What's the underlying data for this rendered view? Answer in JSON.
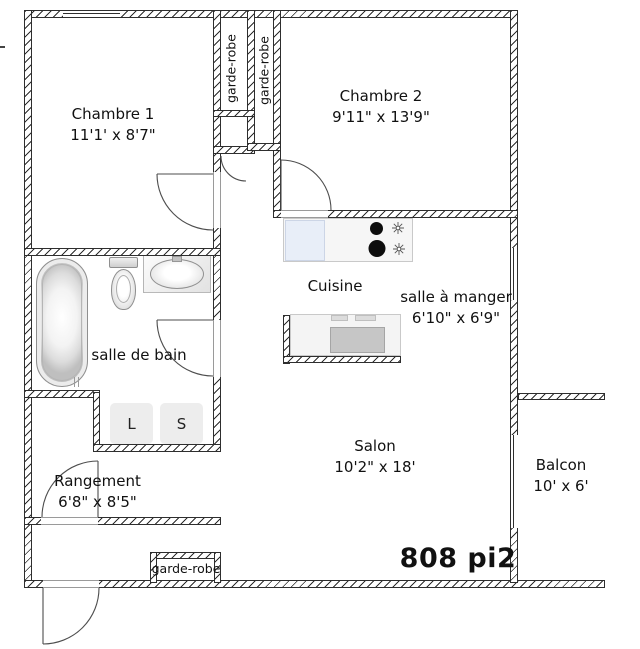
{
  "rooms": {
    "chambre1": {
      "label": "Chambre 1",
      "dims": "11'1' x 8'7\""
    },
    "chambre2": {
      "label": "Chambre 2",
      "dims": "9'11\" x 13'9\""
    },
    "cuisine": {
      "label": "Cuisine"
    },
    "salle_a_manger": {
      "label": "salle à manger",
      "dims": "6'10\" x 6'9\""
    },
    "salle_de_bain": {
      "label": "salle de bain"
    },
    "rangement": {
      "label": "Rangement",
      "dims": "6'8\" x 8'5\""
    },
    "salon": {
      "label": "Salon",
      "dims": "10'2\" x 18'"
    },
    "balcon": {
      "label": "Balcon",
      "dims": "10' x 6'"
    }
  },
  "closets": {
    "garde_robe_1": "garde-robe",
    "garde_robe_2": "garde-robe",
    "garde_robe_entree": "garde-robe"
  },
  "laundry": {
    "washer": "L",
    "dryer": "S"
  },
  "total_area": "808 pi2",
  "colors": {
    "wall_line": "#2e2e2e",
    "fridge_blue": "#e8eef8",
    "appliance_gray": "#c6c6c6"
  }
}
